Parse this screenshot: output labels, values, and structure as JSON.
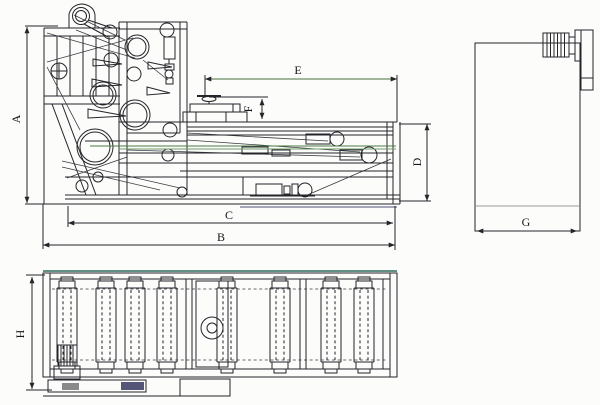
{
  "page": {
    "background": "#fcfcfa",
    "ink": "#24242a"
  },
  "colors": {
    "belt_line_green": "#4a7d46",
    "dimension_line_green": "#47703f",
    "plan_top_edge_teal": "#2e6b5c",
    "divider_gray": "#9a9a9a",
    "base_bar_gray": "#8a8a8a",
    "base_bar_blue": "#555578"
  },
  "dimension_labels": {
    "a": "A",
    "b": "B",
    "c": "C",
    "d": "D",
    "e": "E",
    "f": "F",
    "g": "G",
    "h": "H"
  }
}
